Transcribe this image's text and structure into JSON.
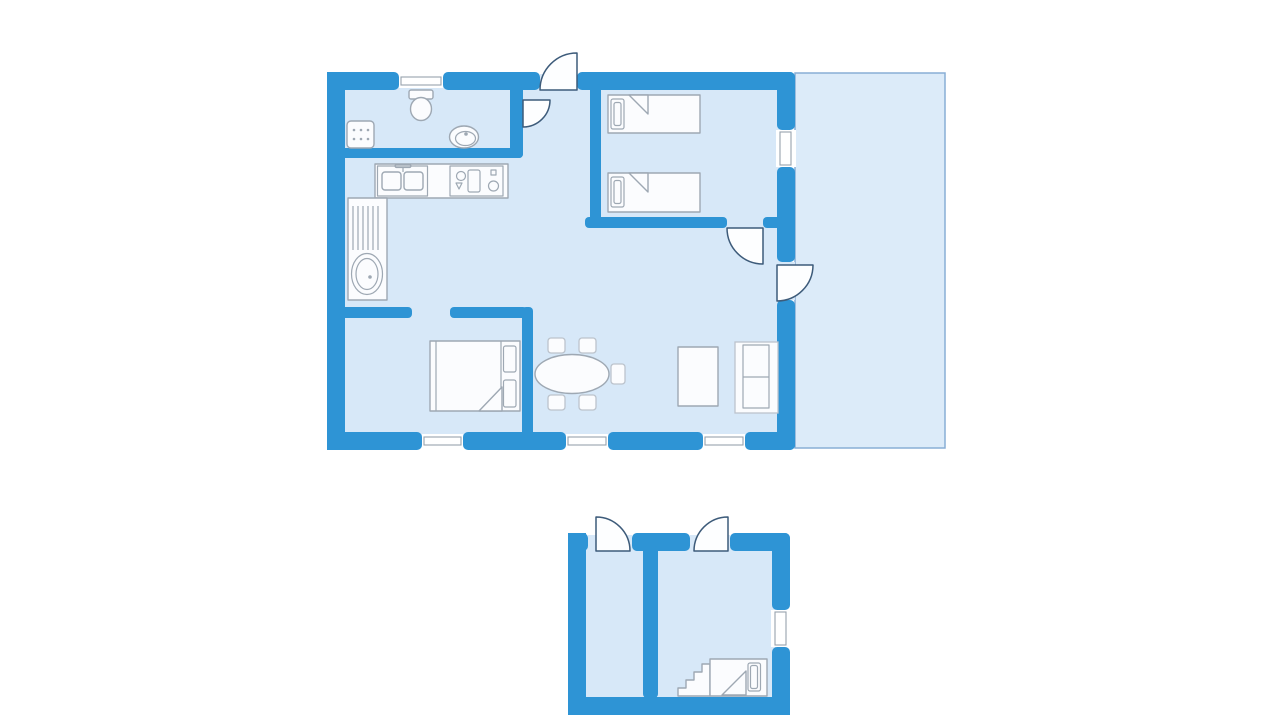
{
  "colors": {
    "bg": "#ffffff",
    "wall": "#2E94D5",
    "floor": "#D7E8F8",
    "terrace": "#DCEBF9",
    "terrace_border": "#88AED5",
    "furn_fill": "#FBFCFE",
    "furn_stroke": "#9EA8B3",
    "furn_stroke_soft": "#BCC3CC",
    "door_fill": "#FDFEFF",
    "door_stroke": "#3D5B7A",
    "window_fill": "#FFFFFF",
    "glass": "#97A2AE"
  },
  "labels": {
    "plan": "Holiday home floor plan",
    "main_house": "Main house",
    "terrace": "Terrace",
    "bathroom": "Bathroom",
    "kitchen": "Kitchen",
    "hall": "Entrance hall",
    "bedroom_1": "Bedroom with two single beds",
    "bedroom_2": "Bedroom with double bed",
    "living_dining": "Living and dining room",
    "outbuilding": "Annex outbuilding",
    "storage_room": "Storage room",
    "bunk_room": "Bunk room",
    "washing_machine": "Washing machine",
    "toilet": "Toilet",
    "hand_basin": "Hand basin",
    "kitchen_sink": "Kitchen double sink",
    "stove": "Stove",
    "worktop": "Worktop with drainer",
    "laundry_tub": "Round basin",
    "single_bed_1": "Single bed",
    "single_bed_2": "Single bed",
    "double_bed": "Double bed",
    "dining_table": "Dining table",
    "dining_chair": "Dining chair",
    "coffee_table": "Coffee table",
    "sofa": "Sofa",
    "bunk_bed": "Bed with steps",
    "steps": "Bed steps",
    "entrance_door": "Entrance door",
    "bathroom_door": "Bathroom door",
    "bedroom_door": "Bedroom door",
    "terrace_door": "Terrace door",
    "storage_door": "Storage room door",
    "bunk_room_door": "Bunk room door",
    "window": "Window"
  }
}
